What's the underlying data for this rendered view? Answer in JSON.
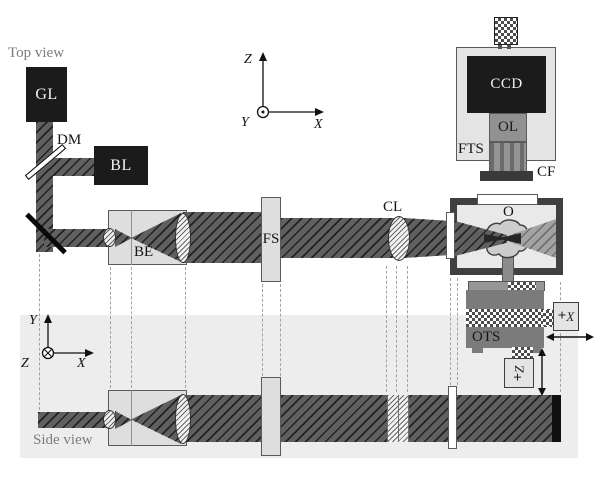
{
  "view_labels": {
    "top": "Top view",
    "side": "Side view"
  },
  "components": {
    "gl": "GL",
    "dm": "DM",
    "bl": "BL",
    "be": "BE",
    "fs": "FS",
    "cl": "CL",
    "o": "O",
    "ccd": "CCD",
    "ol": "OL",
    "fts": "FTS",
    "cf": "CF",
    "ots": "OTS"
  },
  "axes": {
    "top": {
      "vertical": "Z",
      "horizontal": "X",
      "out_of_plane": "Y"
    },
    "side": {
      "vertical": "Y",
      "horizontal": "X",
      "into_plane": "Z"
    }
  },
  "motors": {
    "x": {
      "symbol": "+",
      "axis": "X"
    },
    "z": {
      "symbol": "+",
      "axis": "Z"
    }
  },
  "colors": {
    "beam_fill": "#606060",
    "beam_hatch": "#1f1f1f",
    "black_component": "#1b1b1b",
    "light_component": "#dedede",
    "chamber_frame": "#404040",
    "stage_gray": "#7b7b7b",
    "panel_bg": "#ededed"
  }
}
